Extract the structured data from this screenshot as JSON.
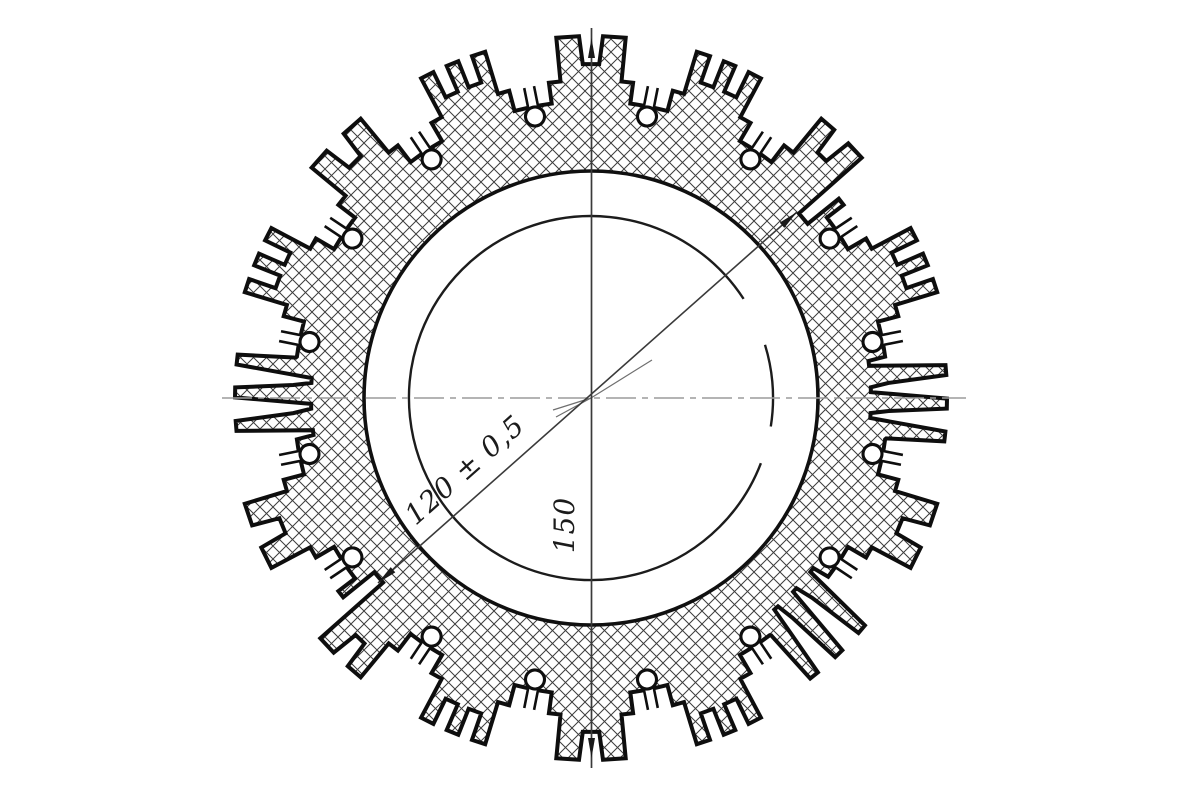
{
  "drawing": {
    "kind": "technical-section-drawing",
    "background": "#ffffff",
    "colors": {
      "outline": "#0e0e0e",
      "ring_circle": "#101010",
      "bore_circle": "#1c1c1c",
      "hatch": "#3d3d3d",
      "centerline": "#9b9b9b",
      "dim_line": "#3a3a3a",
      "dim_arrow": "#1a1a1a",
      "center_marks": "#6f6f6f"
    },
    "center": {
      "x": 591,
      "y": 398
    },
    "radii": {
      "bore": 182,
      "ring_inner": 227,
      "valley": 297,
      "ledge": 318,
      "face": 362,
      "slot_bottom": 334,
      "keyhole_pos": 287,
      "keyhole_radius": 9.5
    },
    "hatch_spacing": 13,
    "cluster_count": 16,
    "cluster_pitch_deg": 22.5,
    "first_cluster_angle_deg": 90,
    "cluster_types": [
      "castle2",
      "castle3",
      "castle2",
      "castle3",
      "comb",
      "castle2",
      "castle2n",
      "castle3",
      "castle2",
      "castle3",
      "comb",
      "castle2",
      "comb",
      "castle3",
      "castle2n",
      "castle3"
    ],
    "cluster_shapes": {
      "castle2": [
        [
          -9.8,
          297
        ],
        [
          -7.6,
          297
        ],
        [
          -7.6,
          318
        ],
        [
          -5.5,
          318
        ],
        [
          -5.5,
          362
        ],
        [
          -1.9,
          362
        ],
        [
          -1.4,
          334
        ],
        [
          1.4,
          334
        ],
        [
          1.9,
          362
        ],
        [
          5.5,
          362
        ],
        [
          5.5,
          318
        ],
        [
          7.6,
          318
        ],
        [
          7.6,
          297
        ],
        [
          9.8,
          297
        ]
      ],
      "castle3": [
        [
          -9.8,
          297
        ],
        [
          -7.6,
          297
        ],
        [
          -7.6,
          318
        ],
        [
          -5.5,
          318
        ],
        [
          -5.5,
          362
        ],
        [
          -3.3,
          362
        ],
        [
          -3.3,
          334
        ],
        [
          -1.0,
          334
        ],
        [
          -1.0,
          362
        ],
        [
          1.0,
          362
        ],
        [
          1.0,
          334
        ],
        [
          3.3,
          334
        ],
        [
          3.3,
          362
        ],
        [
          5.5,
          362
        ],
        [
          5.5,
          318
        ],
        [
          7.6,
          318
        ],
        [
          7.6,
          297
        ],
        [
          9.8,
          297
        ]
      ],
      "castle2n": [
        [
          -9.8,
          297
        ],
        [
          -7.6,
          297
        ],
        [
          -7.6,
          318
        ],
        [
          -6.2,
          318
        ],
        [
          -6.2,
          278
        ],
        [
          -3.4,
          278
        ],
        [
          -3.4,
          362
        ],
        [
          -0.3,
          362
        ],
        [
          0.2,
          334
        ],
        [
          2.3,
          334
        ],
        [
          2.8,
          362
        ],
        [
          5.5,
          362
        ],
        [
          5.5,
          318
        ],
        [
          7.6,
          318
        ],
        [
          7.6,
          297
        ],
        [
          9.8,
          297
        ]
      ],
      "comb": [
        [
          -9.8,
          297
        ],
        [
          -8.0,
          297
        ],
        [
          -7.8,
          298
        ],
        [
          -7.0,
          356
        ],
        [
          -5.4,
          356
        ],
        [
          -4.1,
          280
        ],
        [
          -3.1,
          280
        ],
        [
          -2.5,
          298
        ],
        [
          -1.7,
          356
        ],
        [
          -0.1,
          356
        ],
        [
          1.2,
          280
        ],
        [
          2.2,
          280
        ],
        [
          2.9,
          298
        ],
        [
          3.7,
          356
        ],
        [
          5.3,
          356
        ],
        [
          6.6,
          280
        ],
        [
          7.6,
          280
        ],
        [
          8.0,
          297
        ],
        [
          9.8,
          297
        ]
      ]
    },
    "bore_arc_gaps_deg": [
      [
        17,
        33
      ],
      [
        339,
        351
      ]
    ],
    "centerline_horizontal": {
      "x1": 222,
      "y": 398,
      "x2": 966,
      "dash": "30 6 6 6"
    },
    "dimension_150": {
      "x": 591.5,
      "y1": 28,
      "y2": 768,
      "arrow_tip_top_y": 38,
      "arrow_tip_bottom_y": 758
    },
    "dimension_120": {
      "x1": 378,
      "y1": 583,
      "x2": 797,
      "y2": 212
    },
    "center_marks": [
      [
        553,
        410,
        591,
        398
      ],
      [
        556,
        417,
        591,
        398
      ],
      [
        591,
        398,
        652,
        360
      ]
    ]
  },
  "dimensions": {
    "bore": {
      "label": "120 ± 0,5",
      "tx": 471,
      "ty": 477,
      "rot": -41.5
    },
    "height": {
      "label": "150",
      "tx": 574,
      "ty": 525,
      "rot": -90
    }
  }
}
